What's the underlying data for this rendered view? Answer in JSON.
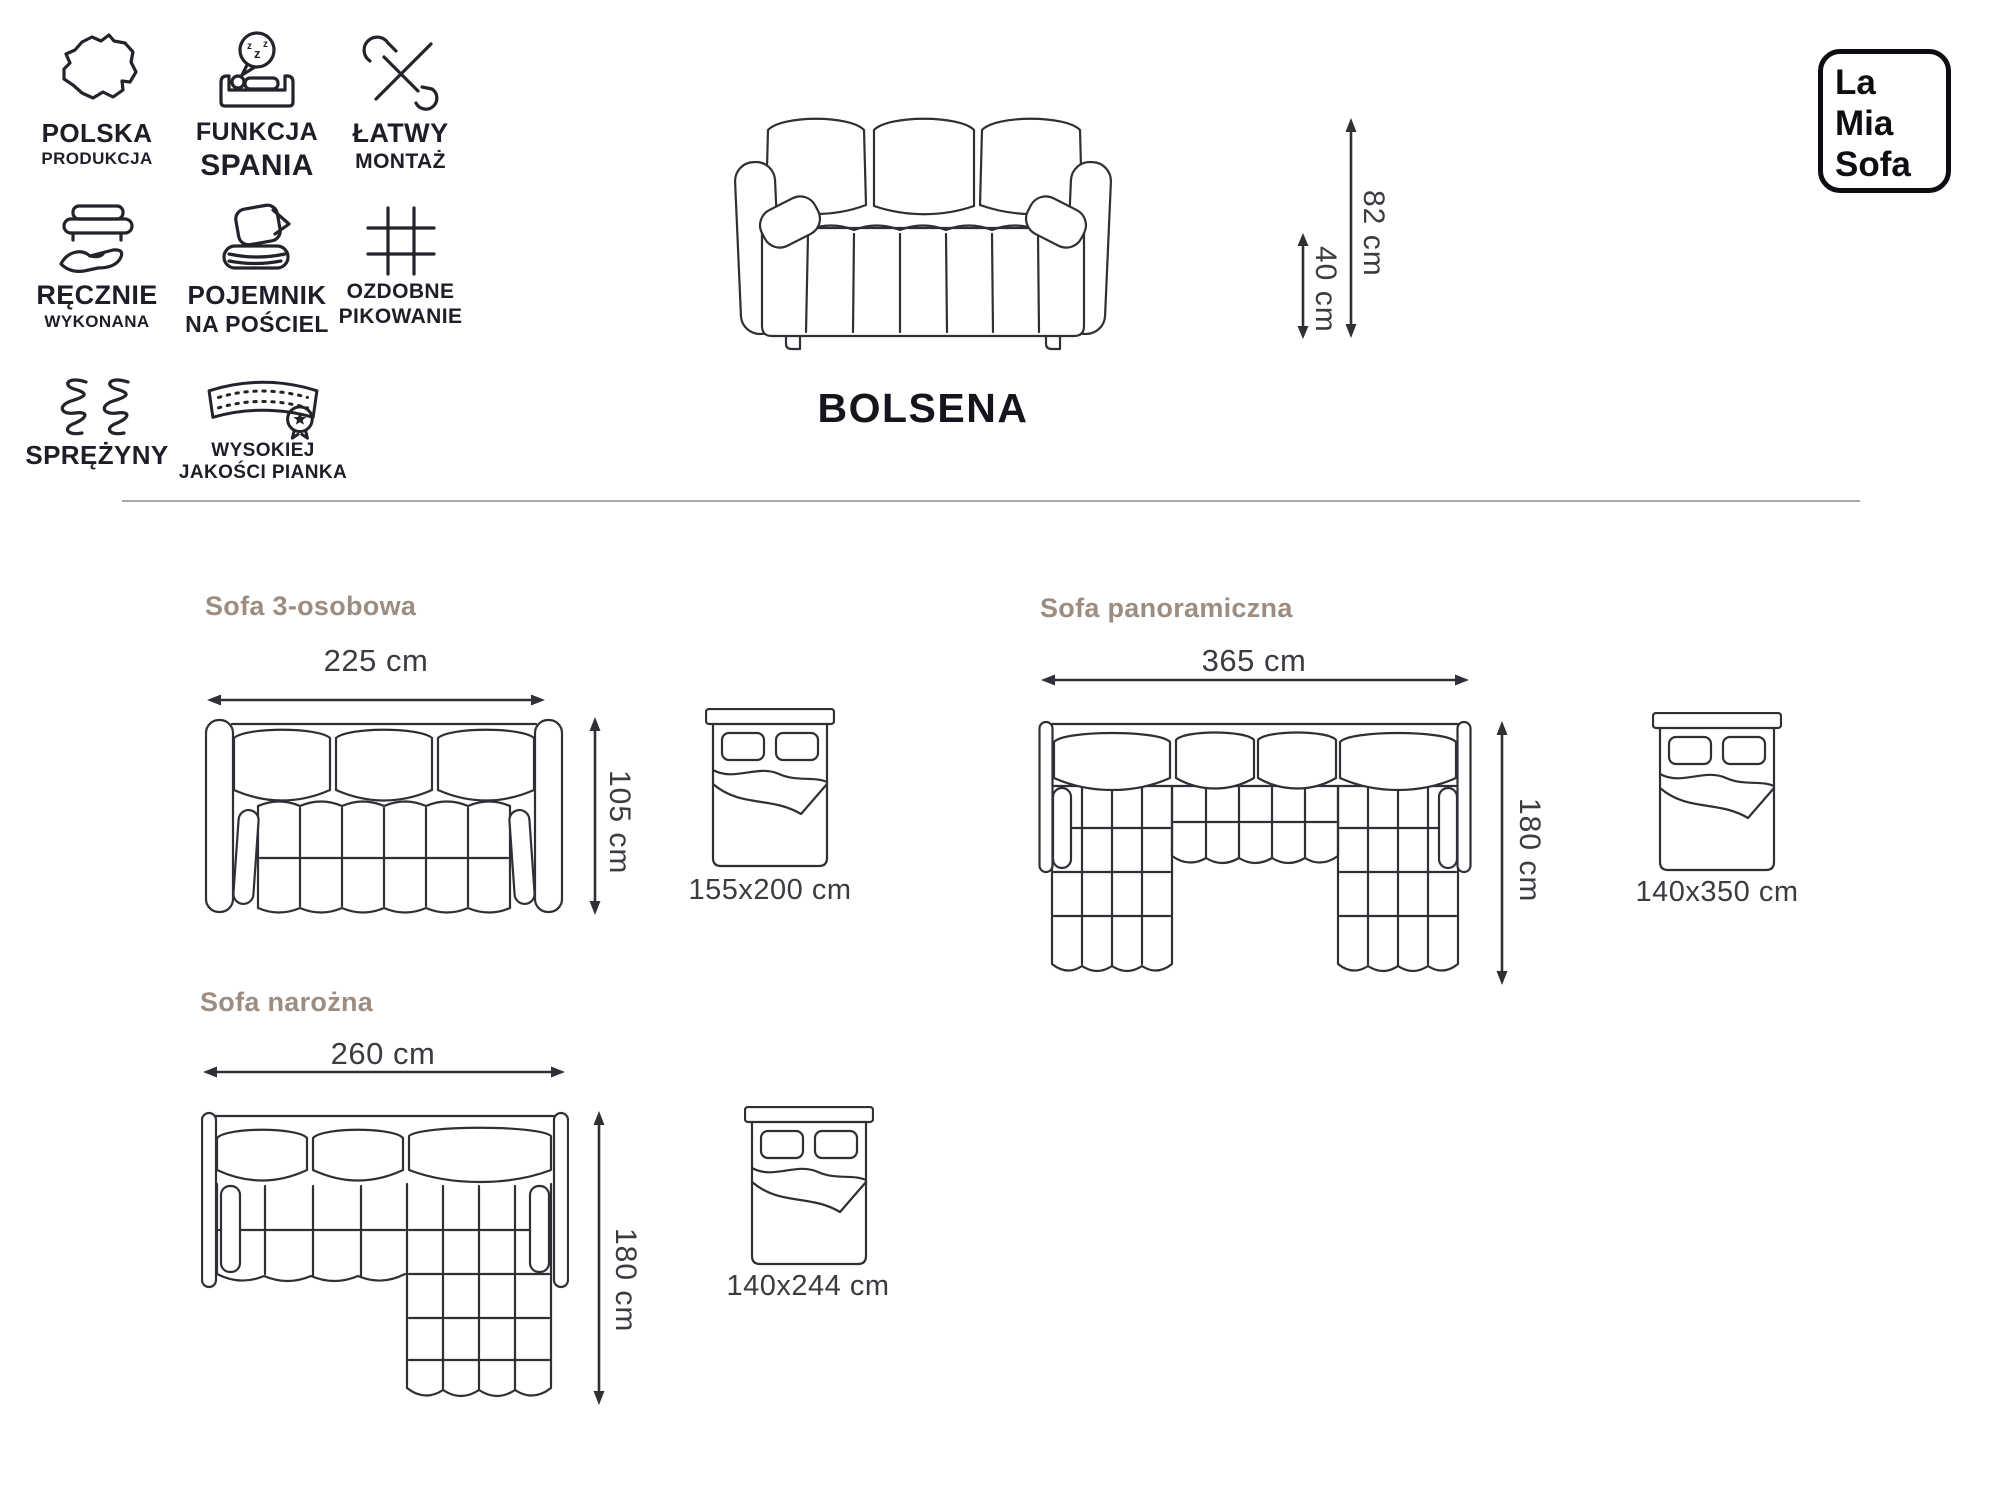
{
  "brand": {
    "line1": "La",
    "line2": "Mia",
    "line3": "Sofa"
  },
  "product": {
    "name": "BOLSENA",
    "height_label": "82 cm",
    "seat_height_label": "40 cm"
  },
  "features": {
    "items": [
      {
        "icon": "poland-map-icon",
        "line1": "POLSKA",
        "line2": "PRODUKCJA"
      },
      {
        "icon": "sleep-function-icon",
        "line1": "FUNKCJA",
        "line2": "SPANIA",
        "bubble": [
          "z",
          "z",
          "z"
        ]
      },
      {
        "icon": "easy-assembly-icon",
        "line1": "ŁATWY",
        "line2": "MONTAŻ"
      },
      {
        "icon": "handmade-icon",
        "line1": "RĘCZNIE",
        "line2": "WYKONANA"
      },
      {
        "icon": "bedding-storage-icon",
        "line1": "POJEMNIK",
        "line2": "NA POŚCIEL"
      },
      {
        "icon": "decorative-quilting-icon",
        "line1": "OZDOBNE",
        "line2": "PIKOWANIE"
      },
      {
        "icon": "springs-icon",
        "line1": "SPRĘŻYNY",
        "line2": ""
      },
      {
        "icon": "quality-foam-icon",
        "line1": "WYSOKIEJ",
        "line2": "JAKOŚCI PIANKA"
      }
    ]
  },
  "variants": [
    {
      "title": "Sofa 3-osobowa",
      "width_label": "225 cm",
      "depth_label": "105 cm",
      "bed_label": "155x200 cm"
    },
    {
      "title": "Sofa panoramiczna",
      "width_label": "365 cm",
      "depth_label": "180 cm",
      "bed_label": "140x350 cm"
    },
    {
      "title": "Sofa narożna",
      "width_label": "260 cm",
      "depth_label": "180 cm",
      "bed_label": "140x244 cm"
    }
  ],
  "colors": {
    "heading": "#9d8d80",
    "line_art": "#2f2f36",
    "dimension_text": "#3b3b42",
    "dark_text": "#15151d",
    "divider": "#a8a8a8"
  }
}
